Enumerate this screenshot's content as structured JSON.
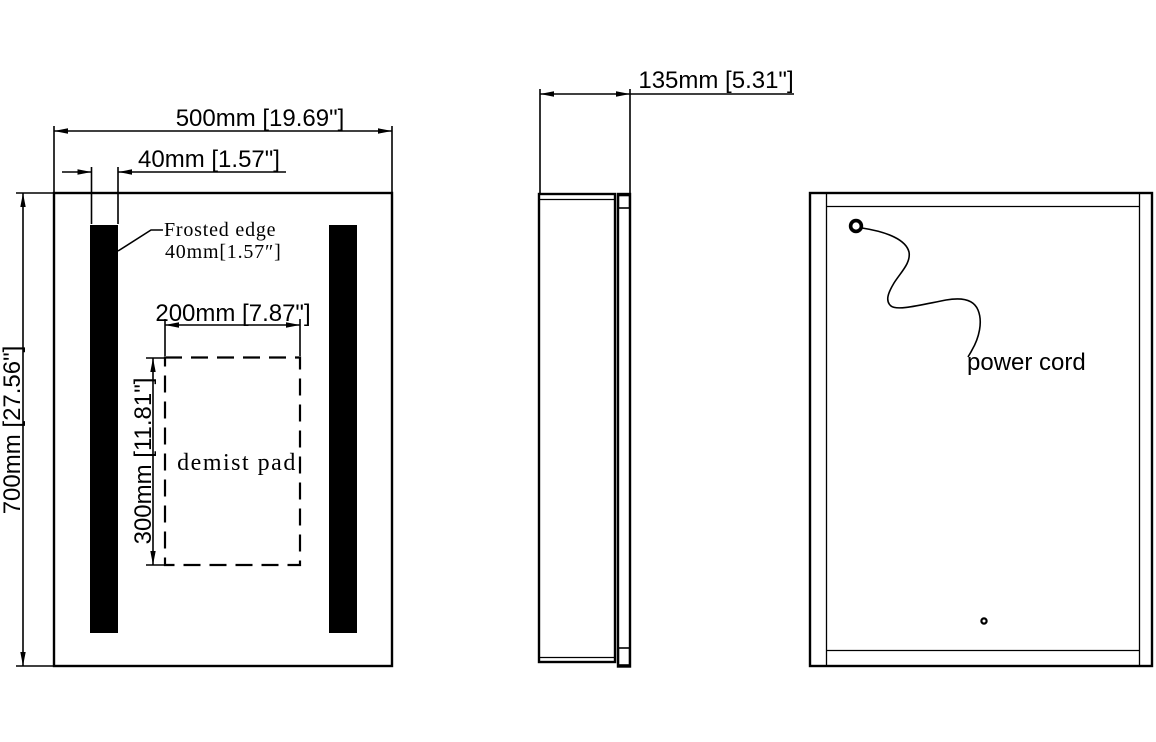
{
  "colors": {
    "line": "#000000",
    "background": "#ffffff"
  },
  "front_view": {
    "overall_width": "500mm [19.69\"]",
    "strip_width": "40mm [1.57\"]",
    "overall_height": "700mm [27.56\"]",
    "frosted_note_line1": "Frosted edge",
    "frosted_note_line2": "40mm[1.57″]",
    "demist_width": "200mm [7.87\"]",
    "demist_height": "300mm [11.81\"]",
    "demist_label": "demist pad"
  },
  "side_view": {
    "depth": "135mm [5.31\"]"
  },
  "back_view": {
    "cord_label": "power cord"
  }
}
